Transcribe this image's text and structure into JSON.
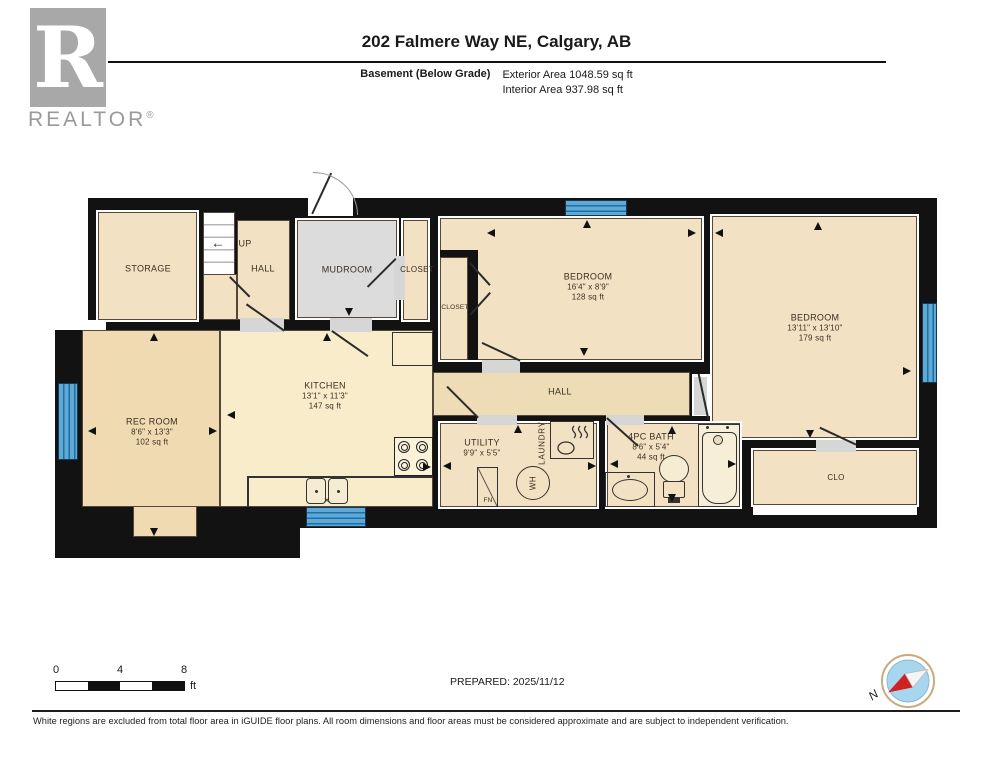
{
  "header": {
    "logo_letter": "R",
    "brand": "REALTOR",
    "reg": "®",
    "title": "202 Falmere Way NE, Calgary, AB",
    "floor_label": "Basement (Below Grade)",
    "exterior_area": "Exterior Area 1048.59 sq ft",
    "interior_area": "Interior Area 937.98 sq ft"
  },
  "rooms": {
    "storage": {
      "name": "STORAGE"
    },
    "stairs": {
      "label": "UP",
      "arrow": "←"
    },
    "hall_upper": {
      "name": "HALL"
    },
    "mudroom": {
      "name": "MUDROOM"
    },
    "closet_a": {
      "name": "CLOSET"
    },
    "closet_b": {
      "name": "CLOSET"
    },
    "bedroom_a": {
      "name": "BEDROOM",
      "dims": "16'4\" x 8'9\"",
      "area": "128 sq ft"
    },
    "bedroom_b": {
      "name": "BEDROOM",
      "dims": "13'11\" x 13'10\"",
      "area": "179 sq ft"
    },
    "rec_room": {
      "name": "REC ROOM",
      "dims": "8'6\" x 13'3\"",
      "area": "102 sq ft"
    },
    "kitchen": {
      "name": "KITCHEN",
      "dims": "13'1\" x 11'3\"",
      "area": "147 sq ft"
    },
    "hall": {
      "name": "HALL"
    },
    "utility": {
      "name": "UTILITY",
      "dims": "9'9\" x 5'5\""
    },
    "laundry": {
      "name": "LAUNDRY"
    },
    "bath": {
      "name": "4PC BATH",
      "dims": "8'6\" x 5'4\"",
      "area": "44 sq ft"
    },
    "closet_c": {
      "name": "CLO"
    },
    "furnace": {
      "label": "FN"
    },
    "water_heater": {
      "label": "WH"
    }
  },
  "footer": {
    "scale": {
      "t0": "0",
      "t4": "4",
      "t8": "8",
      "unit": "ft"
    },
    "prepared": "PREPARED: 2025/11/12",
    "compass_n": "N",
    "disclaimer": "White regions are excluded from total floor area in iGUIDE floor plans. All room dimensions and floor areas must be considered approximate and are subject to independent verification."
  },
  "colors": {
    "wall": "#121212",
    "room_tan": "#f3e1c3",
    "kitchen_yellow": "#f8ecca",
    "rec_tan": "#efdab2",
    "hall_tan": "#eedcb6",
    "mudroom_grey": "#dcdcdc",
    "window_blue": "#5ea9d6",
    "compass_red": "#cc2222"
  }
}
